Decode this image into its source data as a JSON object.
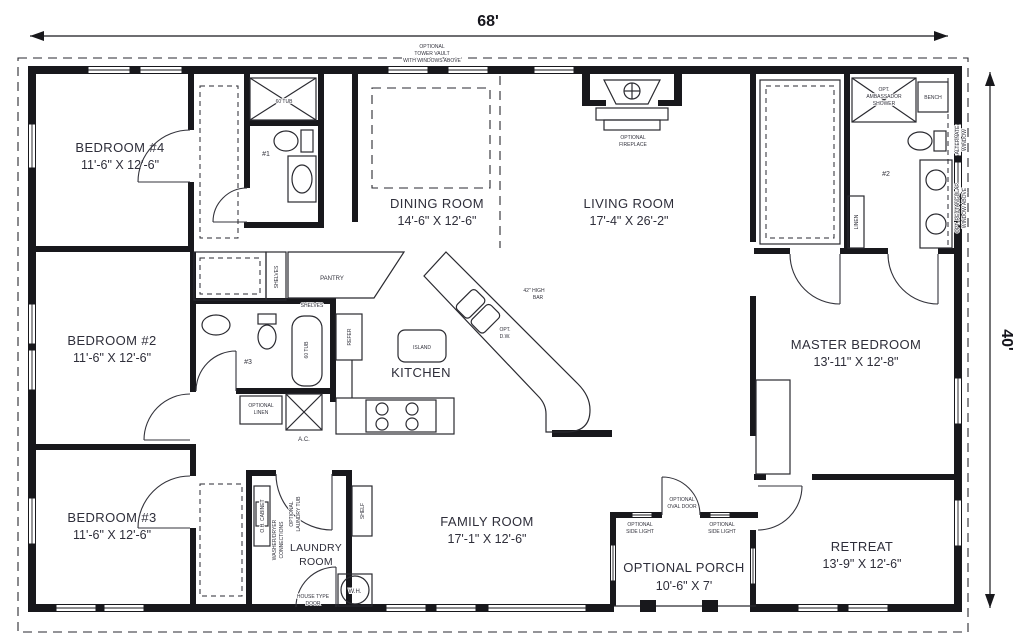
{
  "dimensions": {
    "width": "68'",
    "depth": "40'"
  },
  "rooms": {
    "bedroom4": {
      "name": "BEDROOM #4",
      "size": "11'-6\" X 12'-6\""
    },
    "bedroom2": {
      "name": "BEDROOM #2",
      "size": "11'-6\" X 12'-6\""
    },
    "bedroom3": {
      "name": "BEDROOM #3",
      "size": "11'-6\" X 12'-6\""
    },
    "dining": {
      "name": "DINING ROOM",
      "size": "14'-6\" X 12'-6\""
    },
    "living": {
      "name": "LIVING ROOM",
      "size": "17'-4\" X 26'-2\""
    },
    "kitchen": {
      "name": "KITCHEN"
    },
    "family": {
      "name": "FAMILY ROOM",
      "size": "17'-1\" X 12'-6\""
    },
    "master": {
      "name": "MASTER BEDROOM",
      "size": "13'-11\" X 12'-8\""
    },
    "retreat": {
      "name": "RETREAT",
      "size": "13'-9\" X 12'-6\""
    },
    "porch": {
      "name": "OPTIONAL PORCH",
      "size": "10'-6\" X 7'"
    },
    "laundry": {
      "lines": [
        "LAUNDRY",
        "ROOM"
      ]
    }
  },
  "annotations": {
    "tower_vault": [
      "OPTIONAL",
      "TOWER VAULT",
      "WITH WINDOWS ABOVE"
    ],
    "fireplace": [
      "OPTIONAL",
      "FIREPLACE"
    ],
    "tub_60": "60 TUB",
    "bath1": "#1",
    "bath2": "#2",
    "bath3": "#3",
    "pantry": "PANTRY",
    "shelves": "SHELVES",
    "refer": "REFER",
    "island": "ISLAND",
    "high_bar": [
      "42\" HIGH",
      "BAR"
    ],
    "opt_dw": [
      "OPT.",
      "D.W."
    ],
    "optional_linen": [
      "OPTIONAL",
      "LINEN"
    ],
    "ac": "A.C.",
    "oh_cabinet": "O.H. CABINET",
    "washer_dryer": [
      "WASHER/DRYER",
      "CONNECTIONS"
    ],
    "laundry_tub": [
      "OPTIONAL",
      "LAUNDRY TUB"
    ],
    "shelf": "SHELF",
    "water_heater": "W.H.",
    "house_door": [
      "HOUSE TYPE",
      "DOOR"
    ],
    "oval_door": [
      "OPTIONAL",
      "OVAL DOOR"
    ],
    "side_light": [
      "OPTIONAL",
      "SIDE LIGHT"
    ],
    "ambassador": [
      "OPT.",
      "AMBASSADOR",
      "SHOWER"
    ],
    "bench": "BENCH",
    "linen": "LINEN",
    "alternate_window": [
      "ALTERNATE",
      "WINDOW"
    ],
    "rect_window": [
      "OPT. RECTANGULAR",
      "WINDOW ABOVE"
    ]
  },
  "colors": {
    "wall": "#18181c",
    "ink": "#2e2e3a",
    "bg": "#ffffff"
  }
}
